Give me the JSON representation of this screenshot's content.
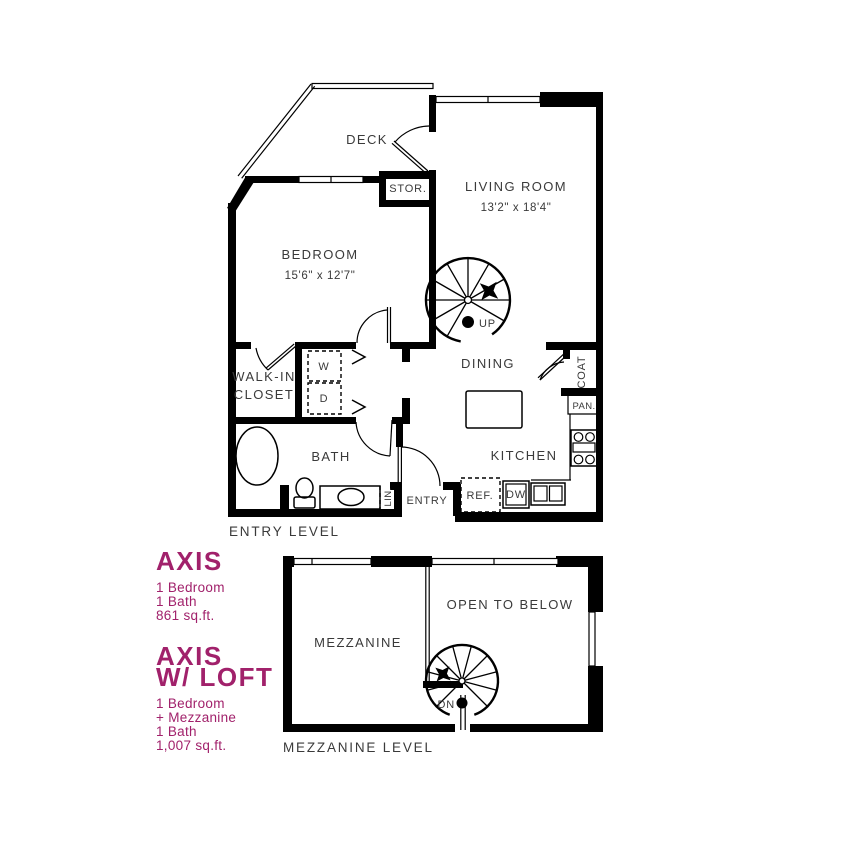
{
  "palette": {
    "accent": "#a1216b",
    "ink": "#3a3a3a",
    "wall": "#000000"
  },
  "entry_level": {
    "caption": "ENTRY LEVEL",
    "labels": {
      "deck": "DECK",
      "living_room": "LIVING ROOM",
      "living_room_dims": "13'2\" x 18'4\"",
      "bedroom": "BEDROOM",
      "bedroom_dims": "15'6\" x 12'7\"",
      "storage": "STOR.",
      "walk_in_1": "WALK-IN",
      "walk_in_2": "CLOSET",
      "bath": "BATH",
      "dining": "DINING",
      "kitchen": "KITCHEN",
      "entry": "ENTRY",
      "coat": "COAT",
      "pantry": "PAN.",
      "washer": "W",
      "dryer": "D",
      "linen": "LIN.",
      "refrigerator": "REF.",
      "dishwasher": "DW",
      "stair_up": "UP"
    }
  },
  "mezzanine_level": {
    "caption": "MEZZANINE LEVEL",
    "labels": {
      "mezzanine": "MEZZANINE",
      "open_to_below": "OPEN TO BELOW",
      "stair_down": "DN"
    }
  },
  "plans": {
    "axis": {
      "title": "AXIS",
      "line1": "1 Bedroom",
      "line2": "1 Bath",
      "line3": "861 sq.ft."
    },
    "axis_loft": {
      "title1": "AXIS",
      "title2": "W/ LOFT",
      "line1": "1 Bedroom",
      "line2": "+ Mezzanine",
      "line3": "1 Bath",
      "line4": "1,007 sq.ft."
    }
  }
}
